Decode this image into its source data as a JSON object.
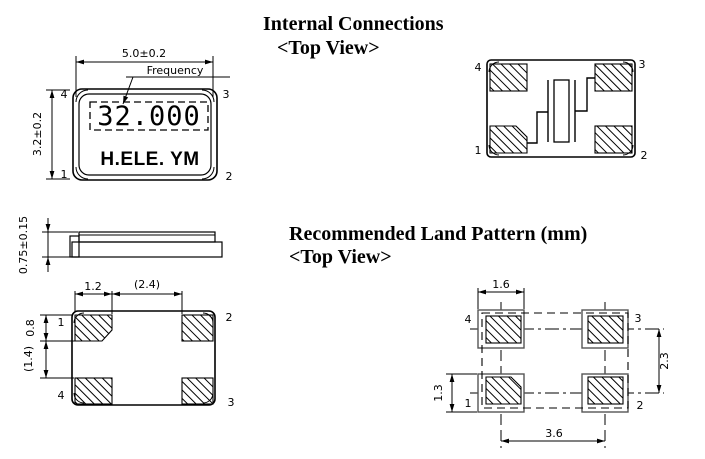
{
  "headings": {
    "internal": {
      "title": "Internal Connections",
      "subtitle": "<Top View>"
    },
    "land": {
      "title": "Recommended Land Pattern (mm)",
      "subtitle": "<Top View>"
    }
  },
  "top_view": {
    "width_dim": "5.0±0.2",
    "height_dim": "3.2±0.2",
    "frequency_label": "Frequency",
    "frequency_value": "32.000",
    "marking": "H.ELE. YM",
    "pin_tl": "4",
    "pin_tr": "3",
    "pin_bl": "1",
    "pin_br": "2"
  },
  "side_view": {
    "height_dim": "0.75±0.15"
  },
  "bottom_view": {
    "pad_width_dim": "1.2",
    "pad_gap_dim": "(2.4)",
    "pad_height_dim": "0.8",
    "pad_vgap_dim": "(1.4)",
    "pin_tl": "1",
    "pin_tr": "2",
    "pin_bl": "4",
    "pin_br": "3"
  },
  "internal_view": {
    "pin_tl": "4",
    "pin_tr": "3",
    "pin_bl": "1",
    "pin_br": "2"
  },
  "land_view": {
    "pad_width_dim": "1.6",
    "row_pitch_dim": "2.3",
    "pad_height_dim": "1.3",
    "col_pitch_dim": "3.6",
    "pin_tl": "4",
    "pin_tr": "3",
    "pin_bl": "1",
    "pin_br": "2"
  },
  "colors": {
    "ink": "#000000",
    "background": "#ffffff"
  }
}
